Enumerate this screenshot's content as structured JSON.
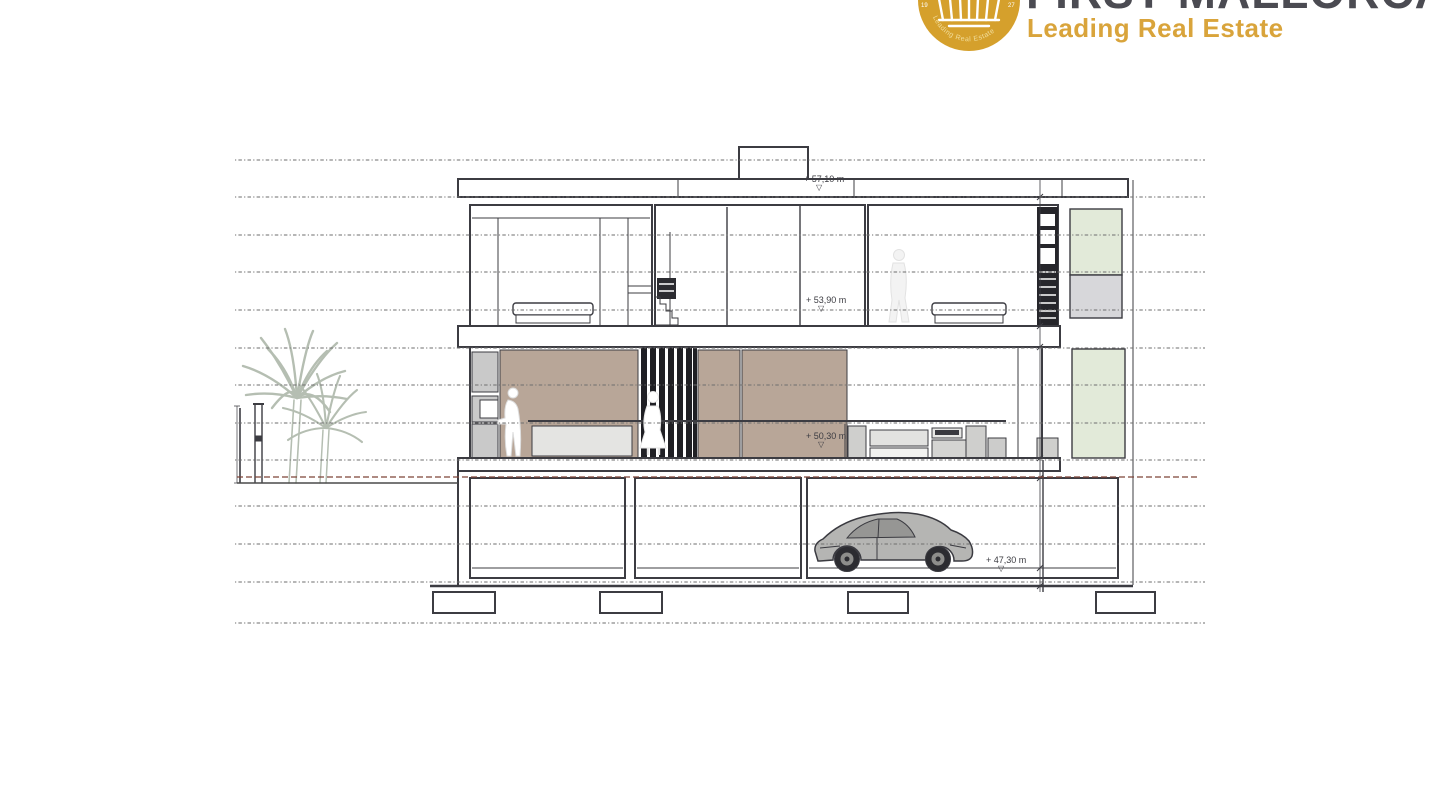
{
  "brand": {
    "wordmark": "FIRST MALLORCA",
    "tagline": "Leading Real Estate",
    "emblem": {
      "left_year": "19",
      "right_year": "27",
      "ring_text": "Leading Real Estate"
    },
    "colors": {
      "gold": "#D5A02C",
      "dark_text": "#4B4B52",
      "tagline_gold": "#D9A43B"
    }
  },
  "drawing": {
    "type": "architectural-section",
    "benchmark_glyph": "▽",
    "levels": [
      {
        "id": "roof",
        "label": "+ 57,10 m"
      },
      {
        "id": "upper-floor",
        "label": "+ 53,90 m"
      },
      {
        "id": "main-floor",
        "label": "+ 50,30 m"
      },
      {
        "id": "garage",
        "label": "+ 47,30 m"
      }
    ],
    "colors": {
      "line": "#3C3C42",
      "taupe_wall": "#B8A698",
      "green_glass": "#E2EAD9",
      "grid_dotted": "#6E6E6E",
      "ground_dashed": "#7D4338",
      "vegetation": "#AEB8AA"
    }
  }
}
